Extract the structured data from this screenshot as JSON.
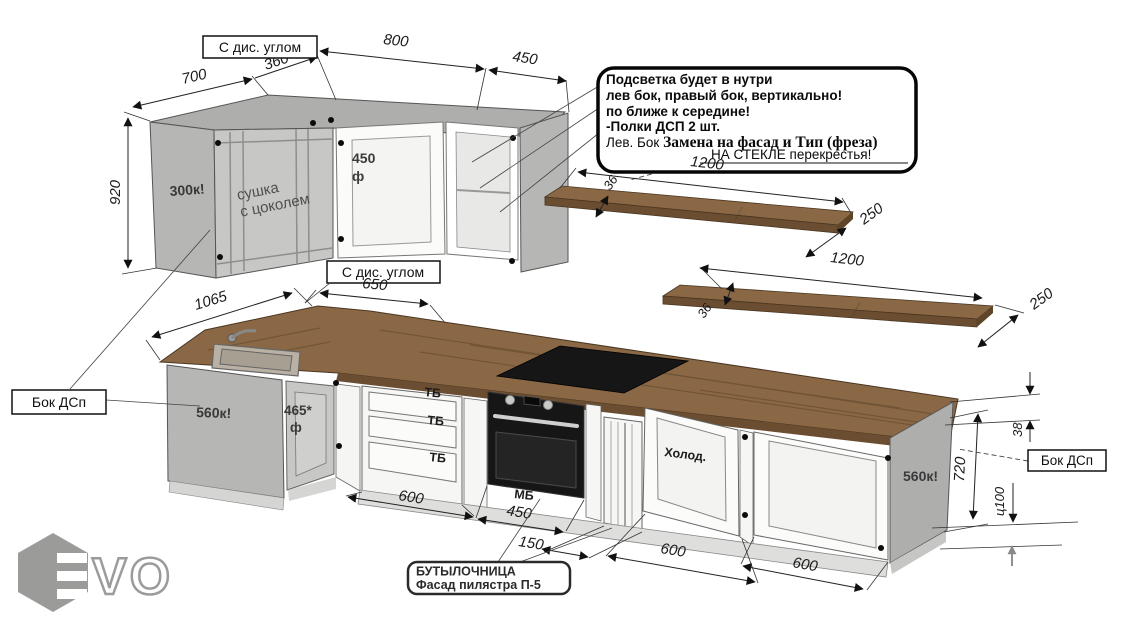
{
  "colors": {
    "wood": "#8a6845",
    "wood_edge": "#6b4e31",
    "wood_dark": "#5e452a",
    "panel_gray": "#b6b6b4",
    "panel_gray_dark": "#aeaeac",
    "corner_gray": "#c7c7c5",
    "glass": "#e8e8e6",
    "door_white": "#fbfbfa",
    "plinth": "#dededc",
    "black": "#161616",
    "logo_gray": "#9b9b99"
  },
  "note_box": {
    "line1": "Подсветка будет в нутри",
    "line2": "лев бок, правый бок, вертикально!",
    "line3": "по ближе к середине!",
    "line4": "-Полки ДСП 2 шт.",
    "line5_prefix": "Лев. Бок ",
    "line5_bold": "Замена на фасад и Тип (фреза)",
    "glass_note": "НА СТЕКЛЕ перекрестья!"
  },
  "labels": {
    "corner_box_top": "С дис. углом",
    "corner_box_bottom": "С дис. углом",
    "side_panel_left": "Бок ДСп",
    "side_panel_right": "Бок ДСп",
    "upper_left_cabinet": "300к!",
    "dryer_line1": "сушка",
    "dryer_line2": "с цоколем",
    "upper_mid_door": "450",
    "upper_mid_door_f": "ф",
    "sink_cabinet": "560к!",
    "corner_door": "465*",
    "corner_door_f": "ф",
    "drawer": "ТБ",
    "oven_module": "МБ",
    "fridge": "Холод.",
    "right_panel_cabinet": "560к!",
    "bottle_line1": "БУТЫЛОЧНИЦА",
    "bottle_line2": "Фасад пилястра П-5"
  },
  "dims": {
    "w700": "700",
    "w360": "360*",
    "w800": "800",
    "w450_upper": "450",
    "h920": "920",
    "w650": "650",
    "shelf_len": "1200",
    "shelf_depth": "250",
    "shelf_thick": "36",
    "w1065": "1065",
    "w600_drawers": "600",
    "w450_oven": "450",
    "w150": "150",
    "w600_fridge": "600",
    "w600_right": "600",
    "t38": "38",
    "h720": "720",
    "plinth_h": "ц100"
  },
  "logo": {
    "wordmark": "VO"
  }
}
